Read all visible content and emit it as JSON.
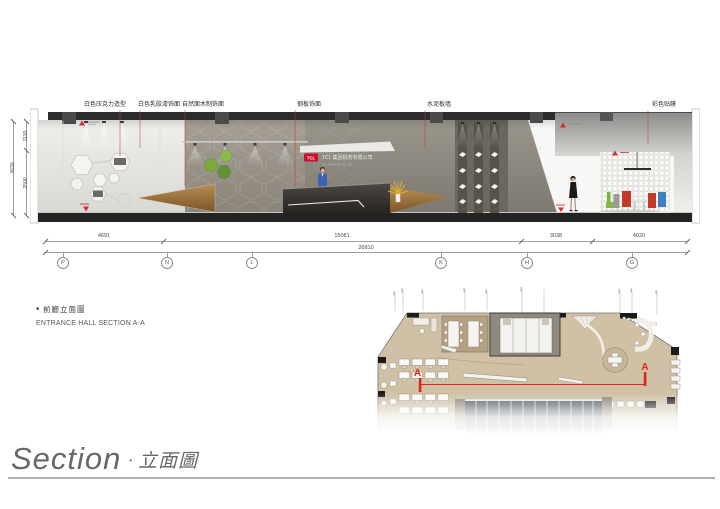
{
  "section": {
    "annotations": [
      "白色压克力造型",
      "白色乳胶漆饰面",
      "自然面木制饰面",
      "钢板饰面",
      "水泥板墙",
      "彩色贴膜"
    ],
    "sign": {
      "logo": "TCL",
      "company_zh": "TCL 集团财务有限公司",
      "company_en": "TCL FINANCE CO.,LTD"
    }
  },
  "dimensions": {
    "horizontal": {
      "segments": [
        "4691",
        "15081",
        "3038",
        "4020"
      ],
      "total": "26810"
    },
    "vertical": {
      "segments": [
        "1130",
        "2500"
      ],
      "total": "3630"
    },
    "grid_bubbles": [
      "P",
      "N",
      "L",
      "K",
      "H",
      "G"
    ]
  },
  "plan": {
    "section_letter": "A"
  },
  "caption": {
    "bullet": "■",
    "zh": "前廳立面圖",
    "en": "ENTRANCE HALL SECTION A-A"
  },
  "footer": {
    "en": "Section",
    "sep": "·",
    "zh": "立面圖"
  },
  "colors": {
    "leader_red": "#c0392b",
    "tcl_red": "#c8102e",
    "section_line_red": "#e0241c",
    "concrete": "#948e84",
    "wood": "#a87c46",
    "plan_floor_tan": "#cfc0a6"
  }
}
